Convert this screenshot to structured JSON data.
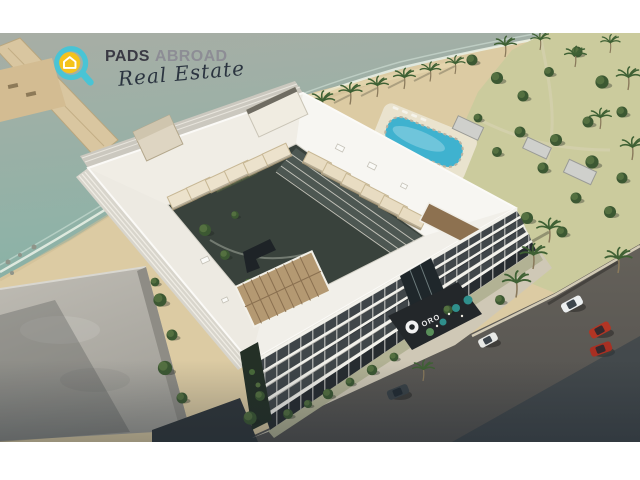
{
  "image": {
    "alt": "Aerial 3D rendering of a white beachfront condominium complex built around a courtyard, with rooftop canopies, palm-lined beach, resort pool, surrounding streets, parked cars and a dark ORO entrance canopy",
    "type": "real-estate-render"
  },
  "logo": {
    "brand_primary": "PADS",
    "brand_secondary": "ABROAD",
    "tagline": "Real Estate"
  },
  "building": {
    "entrance_sign": "ORO"
  },
  "palette": {
    "letterbox": "#ffffff",
    "water": "#8fb2a7",
    "sand": "#dccba3",
    "lawn": "#cbcb9d",
    "roof_white": "#f4f3ee",
    "asphalt": "#5e5a53",
    "sidewalk": "#cfc8b6",
    "pool": "#3fb2cf",
    "canopy_cream": "#ece2cc",
    "canopy_bronze": "#8d7150",
    "canopy_tan": "#b49972",
    "tree_green": "#3f5a34",
    "entrance_dark": "#23272a",
    "car_red": "#b23524",
    "logo_ring": "#49c4d5",
    "logo_badge": "#f4c31c",
    "logo_text_primary": "#3a3a44",
    "logo_text_secondary": "#8d8d95",
    "logo_script": "#2b3440"
  }
}
